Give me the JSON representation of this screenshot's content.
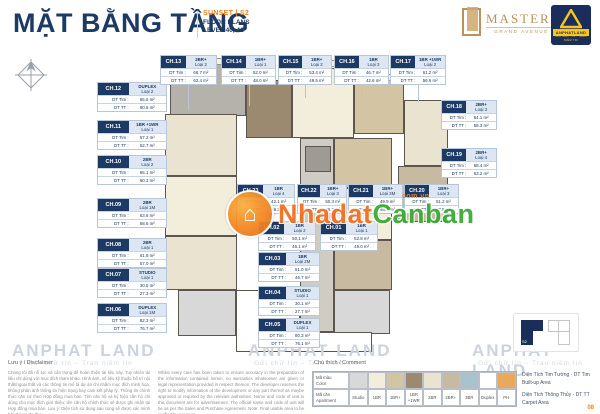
{
  "header": {
    "title": "MẶT BẰNG TẦNG",
    "project": "SUNSET  |  S2",
    "plans": "FLOOR PLANS",
    "level": "LEVEL  40, 42"
  },
  "logos": {
    "masteri": {
      "name": "MASTERI",
      "sub": "GRAND AVENUE"
    },
    "anphat": {
      "name": "ANPHATLAND",
      "tagline": "GỬI CHỮ TÍN - TRAO NIỀM TIN"
    }
  },
  "card_labels": {
    "tim": "DT Tim :",
    "tt": "DT TT :"
  },
  "cards": [
    {
      "code": "CH.12",
      "type": "DUPLEX",
      "variant": "Loại 2",
      "tim": "65.6 m²",
      "tt": "60.6 m²"
    },
    {
      "code": "CH.11",
      "type": "1BR +1WR",
      "variant": "Loại 1",
      "tim": "57.2 m²",
      "tt": "52.7 m²"
    },
    {
      "code": "CH.10",
      "type": "2BR",
      "variant": "Loại 2",
      "tim": "65.1 m²",
      "tt": "60.3 m²"
    },
    {
      "code": "CH.09",
      "type": "2BR",
      "variant": "Loại 1M",
      "tim": "63.6 m²",
      "tt": "58.6 m²"
    },
    {
      "code": "CH.08",
      "type": "2BR",
      "variant": "Loại 1",
      "tim": "61.8 m²",
      "tt": "57.0 m²"
    },
    {
      "code": "CH.07",
      "type": "STUDIO",
      "variant": "Loại 1",
      "tim": "30.5 m²",
      "tt": "27.3 m²"
    },
    {
      "code": "CH.06",
      "type": "DUPLEX",
      "variant": "Loại 1M",
      "tim": "82.3 m²",
      "tt": "76.7 m²"
    },
    {
      "code": "CH.13",
      "type": "2BR+",
      "variant": "Loại 2",
      "tim": "66.7 m²",
      "tt": "62.4 m²"
    },
    {
      "code": "CH.14",
      "type": "1BR+",
      "variant": "Loại 1",
      "tim": "52.0 m²",
      "tt": "48.0 m²"
    },
    {
      "code": "CH.15",
      "type": "1BR+",
      "variant": "Loại 2",
      "tim": "53.4 m²",
      "tt": "49.5 m²"
    },
    {
      "code": "CH.16",
      "type": "1BR",
      "variant": "Loại 3",
      "tim": "46.7 m²",
      "tt": "42.6 m²"
    },
    {
      "code": "CH.17",
      "type": "1BR +1WR",
      "variant": "Loại 2",
      "tim": "61.2 m²",
      "tt": "56.6 m²"
    },
    {
      "code": "CH.18",
      "type": "2BR+",
      "variant": "Loại 3",
      "tim": "64.1 m²",
      "tt": "58.3 m²"
    },
    {
      "code": "CH.19",
      "type": "2BR+",
      "variant": "Loại 4",
      "tim": "68.4 m²",
      "tt": "63.2 m²"
    },
    {
      "code": "CH.23",
      "type": "1BR",
      "variant": "Loại 4",
      "tim": "42.1 m²",
      "tt": "38.2 m²"
    },
    {
      "code": "CH.22",
      "type": "1BR+",
      "variant": "Loại 3",
      "tim": "50.3 m²",
      "tt": "46.3 m²"
    },
    {
      "code": "CH.21",
      "type": "1BR+",
      "variant": "Loại 3M",
      "tim": "49.9 m²",
      "tt": "46.2 m²"
    },
    {
      "code": "CH.20",
      "type": "1BR+",
      "variant": "Loại 3",
      "tim": "51.2 m²",
      "tt": "47.5 m²"
    },
    {
      "code": "CH.02",
      "type": "1BR",
      "variant": "Loại 2",
      "tim": "50.1 m²",
      "tt": "46.1 m²"
    },
    {
      "code": "CH.01",
      "type": "1BR",
      "variant": "Loại 1",
      "tim": "52.8 m²",
      "tt": "49.0 m²"
    },
    {
      "code": "CH.03",
      "type": "1BR",
      "variant": "Loại 2M",
      "tim": "51.0 m²",
      "tt": "46.7 m²"
    },
    {
      "code": "CH.04",
      "type": "STUDIO",
      "variant": "Loại 1",
      "tim": "30.1 m²",
      "tt": "27.7 m²"
    },
    {
      "code": "CH.05",
      "type": "DUPLEX",
      "variant": "Loại 1",
      "tim": "80.3 m²",
      "tt": "76.1 m²"
    }
  ],
  "legend": {
    "heading": "Chú thích / Comment",
    "color_label": "Mã màu\nColor",
    "apt_label": "Mã căn\nApartment",
    "types": [
      {
        "label": "Studio",
        "color": "#d8d8d8"
      },
      {
        "label": "1BR",
        "color": "#f3eddc"
      },
      {
        "label": "1BR+",
        "color": "#d3c5a4"
      },
      {
        "label": "1BR +1WR",
        "color": "#9b8a70"
      },
      {
        "label": "2BR",
        "color": "#e9e3cf"
      },
      {
        "label": "2BR+",
        "color": "#c8baa0"
      },
      {
        "label": "3BR",
        "color": "#a9c3ce"
      },
      {
        "label": "Duplex",
        "color": "#ffffff"
      },
      {
        "label": "PH",
        "color": "#eaa85d"
      }
    ],
    "note_tim": "Diện Tích Tim Tường - DT Tim\nBuilt-up Area",
    "note_tt": "Diện Tích Thông Thủy - DT TT\nCarpet Area"
  },
  "disclaimer": {
    "heading": "Lưu ý / Disclaimer",
    "vi": "Chúng tôi đã nỗ lực và cẩn trọng để hoàn thiện tài liệu này. Tuy nhiên tài liệu chỉ dùng với mục đích tham khảo. Hình ảnh, số liệu kỹ thuật, bố trí nội thất/ngoại thất và các thông tin mô tả dự án chỉ nhằm mục đích minh họa, không phản ánh thông tin hiện trạng hay cam kết pháp lý. Thông tin chính thức căn cứ theo Hợp đồng mua bán. Tên căn hộ và ký hiệu căn hộ chỉ dùng cho mục đích giới thiệu; tên căn hộ chính thức sẽ được ghi nhận tại Hợp đồng mua bán. Lưu ý: Diện tích sử dụng sau cùng sẽ được xác minh bởi đơn vị đo đạc.",
    "en": "Whilst every care has been taken to ensure accuracy in the preparation of the information contained herein, no warranties whatsoever are given or legal representation provided in respect thereon. The developer reserves the right to modify information of the development or any part thereof as maybe approved or required by the relevant authorities. Name and code of unit in this document are for advertisement. The official name and code of unit will be as per the Sales and Purchase Agreement. Note: Final usable area to be verified by surveyor."
  },
  "watermark": {
    "center": {
      "prefix": "Nhadat",
      "suffix": "Canban",
      "domain": "com.vn",
      "icon": "⌂"
    },
    "page_big": "ANPHAT LAND",
    "page_slogan": "Gửi chữ tín   –   Trao niềm tin"
  },
  "keyplan": {
    "label": "S2"
  },
  "page": {
    "number": "08"
  },
  "colors": {
    "navy": "#1d3a64",
    "orange": "#f08221",
    "wm_orange": "#f26f21",
    "wm_green": "#3aaa35",
    "gold": "#b9935a"
  }
}
